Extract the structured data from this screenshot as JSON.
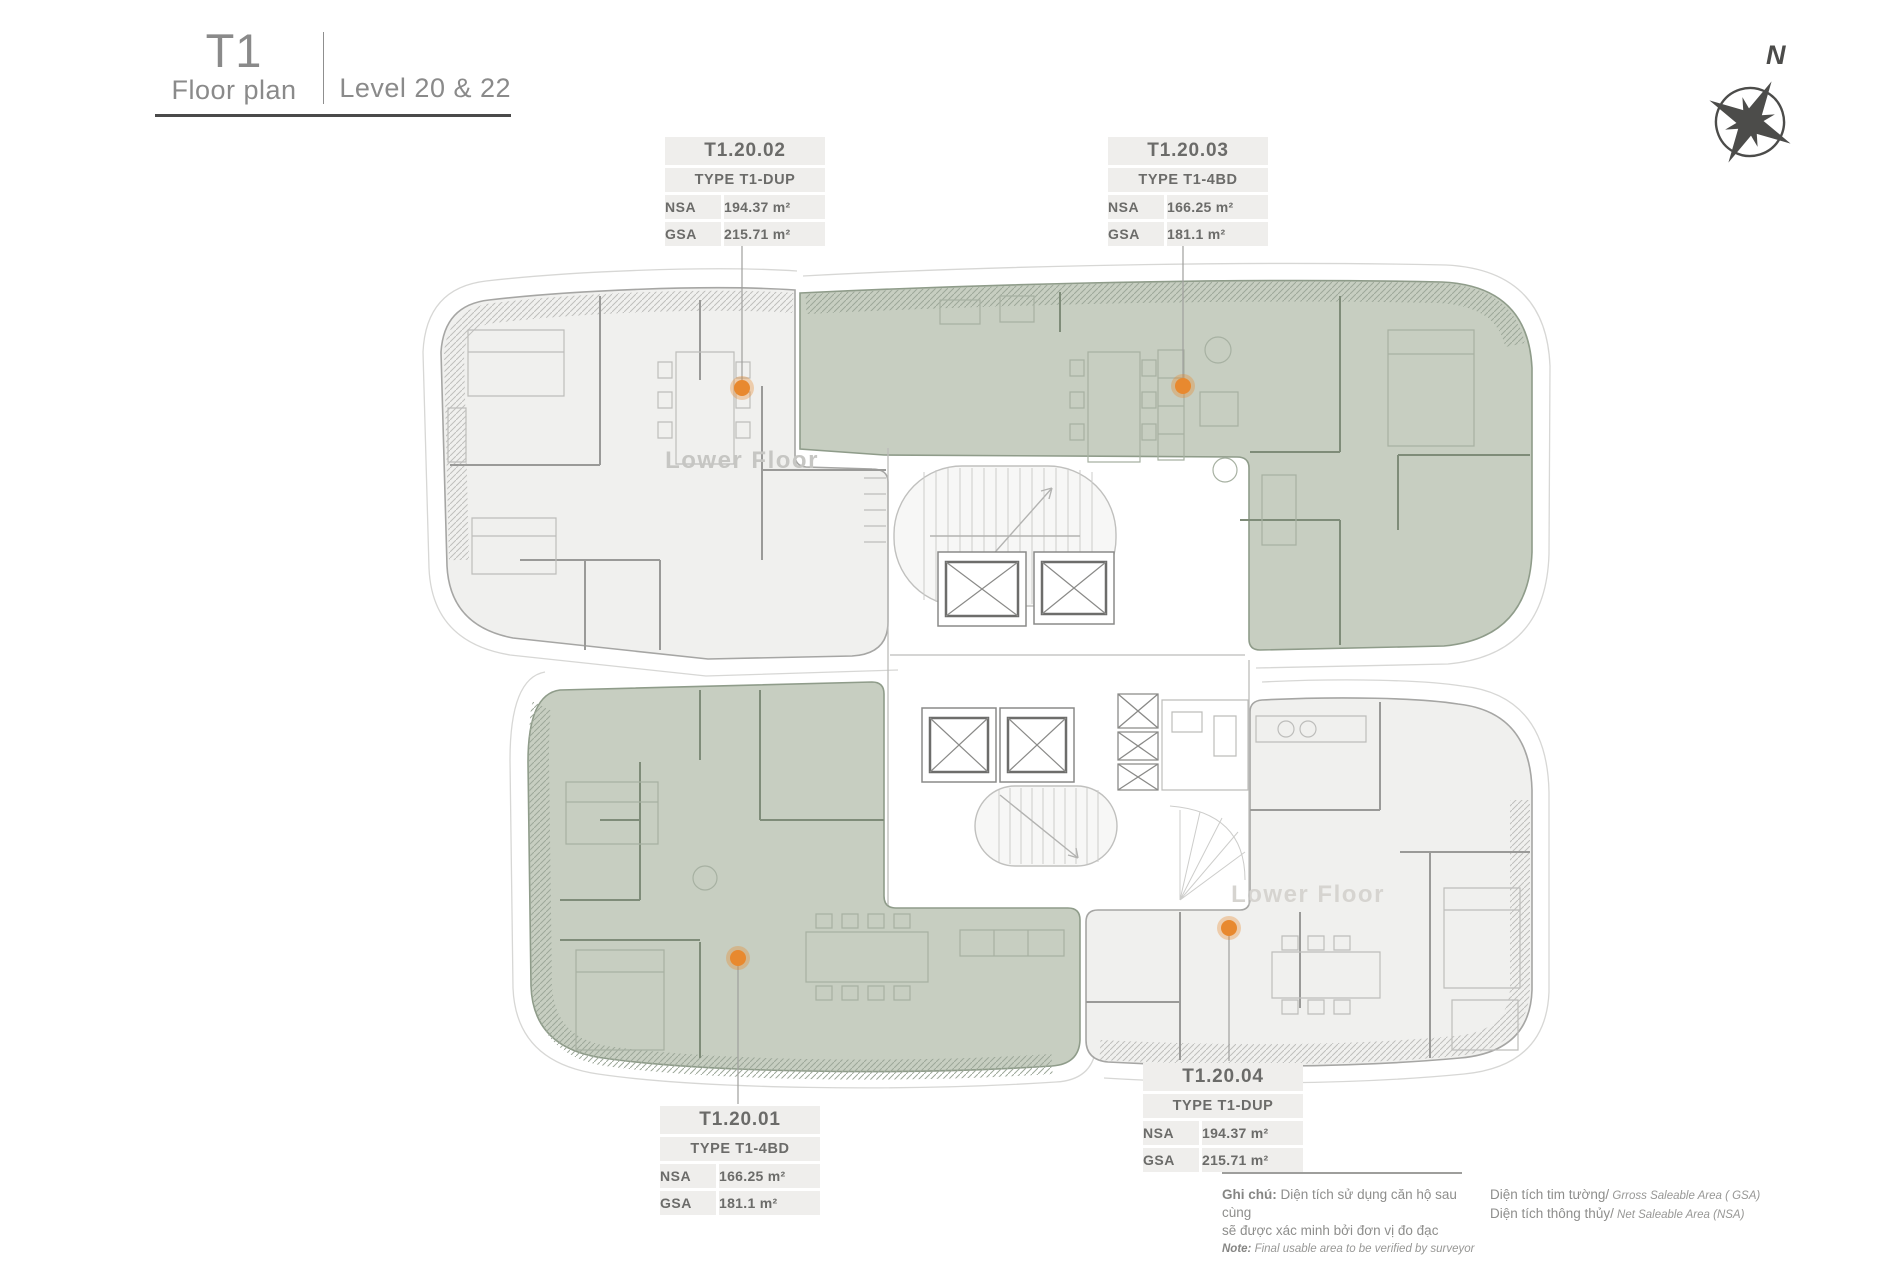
{
  "title": {
    "tower": "T1",
    "caption": "Floor plan",
    "level": "Level 20 & 22"
  },
  "compass": {
    "north": "N"
  },
  "labels": {
    "nsa": "NSA",
    "gsa": "GSA"
  },
  "units": [
    {
      "name": "T1.20.02",
      "type": "TYPE T1-DUP",
      "nsa": "194.37 m²",
      "gsa": "215.71 m²",
      "floor_note": "Lower Floor",
      "highlighted": false
    },
    {
      "name": "T1.20.03",
      "type": "TYPE T1-4BD",
      "nsa": "166.25 m²",
      "gsa": "181.1 m²",
      "highlighted": true
    },
    {
      "name": "T1.20.01",
      "type": "TYPE T1-4BD",
      "nsa": "166.25 m²",
      "gsa": "181.1 m²",
      "highlighted": true
    },
    {
      "name": "T1.20.04",
      "type": "TYPE T1-DUP",
      "nsa": "194.37 m²",
      "gsa": "215.71 m²",
      "floor_note": "Lower Floor",
      "highlighted": false
    }
  ],
  "legend": {
    "note_bold": "Ghi chú:",
    "note_line1": " Diện tích sử dụng căn hộ sau cùng",
    "note_line2": "sẽ được xác minh bởi đơn vị đo đạc",
    "note_en_bold": "Note:",
    "note_en": " Final usable area to be verified by surveyor",
    "gsa_vi": "Diện tích tim tường/",
    "gsa_en": " Grross Saleable Area ( GSA)",
    "nsa_vi": "Diện tích thông thủy/",
    "nsa_en": " Net Saleable Area (NSA)"
  },
  "colors": {
    "unit_highlight": "#c7cec1",
    "unit_plain": "#f0f0ee",
    "marker": "#e8892f",
    "card_bg": "#efeeec",
    "ink": "#6b6b69",
    "title_gray": "#8a8a8a"
  }
}
